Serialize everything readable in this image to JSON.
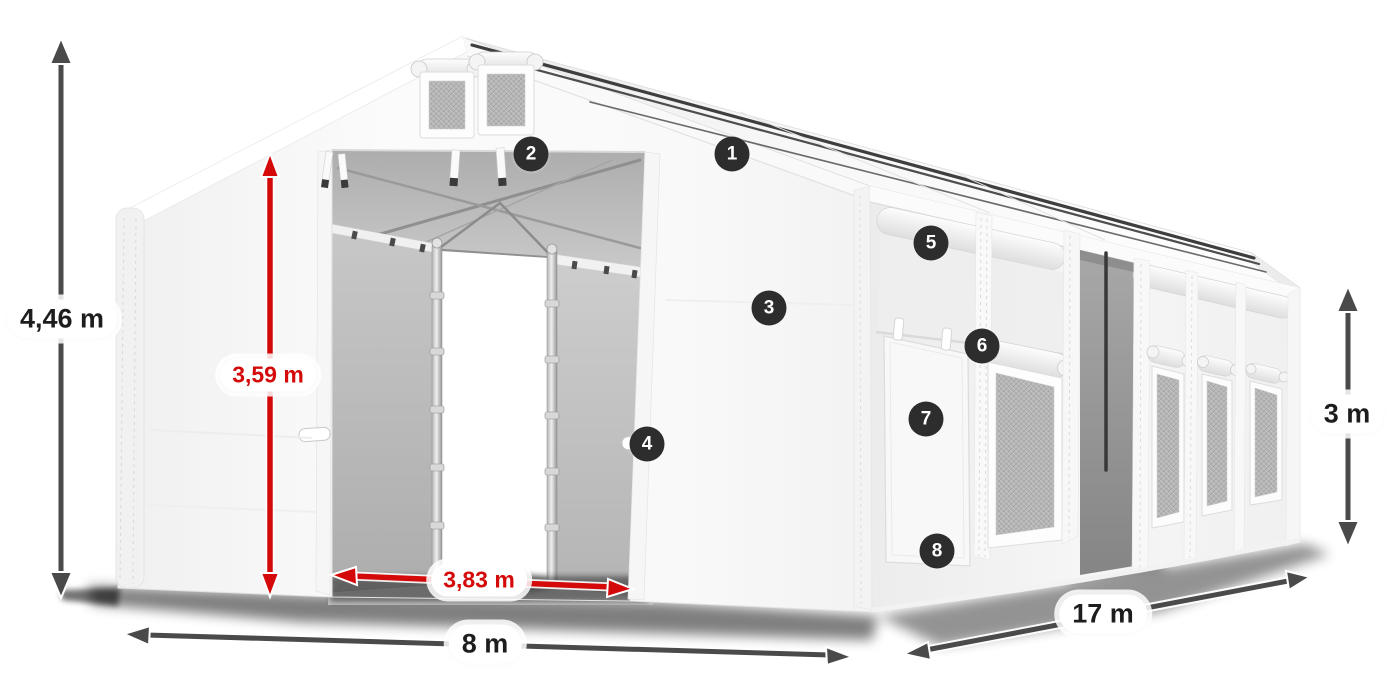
{
  "diagram": {
    "kind": "tent-dimension-diagram",
    "labels": {
      "total_height": "4,46 m",
      "entrance_height": "3,59 m",
      "entrance_width": "3,83 m",
      "front_width": "8 m",
      "side_length": "17 m",
      "side_wall_height": "3 m"
    },
    "callouts": [
      {
        "number": "1"
      },
      {
        "number": "2"
      },
      {
        "number": "3"
      },
      {
        "number": "4"
      },
      {
        "number": "5"
      },
      {
        "number": "6"
      },
      {
        "number": "7"
      },
      {
        "number": "8"
      }
    ],
    "colors": {
      "measure_red": "#d40a0a",
      "measure_gray": "#4a4a4a",
      "callout_badge": "#2d2d2d",
      "tent_white": "#f7f7f7",
      "mesh_gray": "#b7b7b7"
    }
  }
}
